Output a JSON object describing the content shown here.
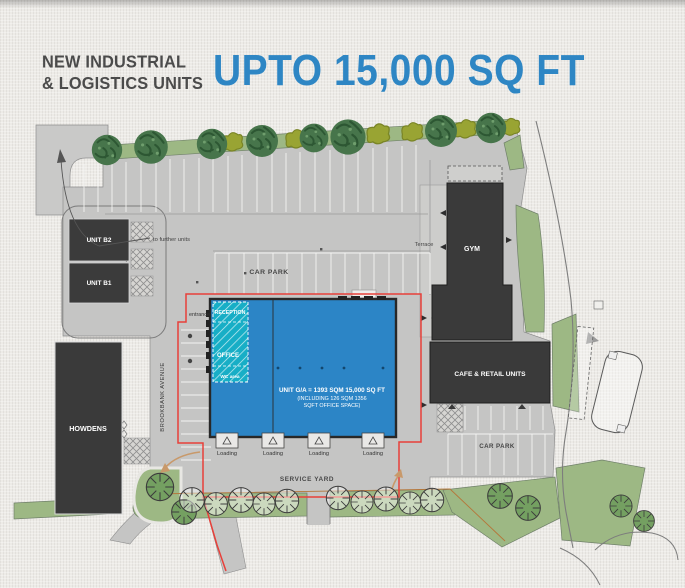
{
  "header": {
    "title_line1": "NEW INDUSTRIAL",
    "title_line2": "& LOGISTICS UNITS",
    "headline": "UPTO 15,000 SQ FT"
  },
  "plan": {
    "labels": {
      "to_further_units": "to further units",
      "unit_b2": "UNIT B2",
      "unit_b1": "UNIT B1",
      "car_park_top": "CAR PARK",
      "car_park_bottom": "CAR PARK",
      "terrace": "Terrace",
      "gym": "GYM",
      "cafe_retail": "CAFE & RETAIL UNITS",
      "howdens": "HOWDENS",
      "brookbank_avenue": "BROOKBANK AVENUE",
      "entrance": "entrance",
      "reception": "RECEPTION",
      "office": "OFFICE",
      "wc_area": "WC area",
      "service_yard": "SERVICE YARD"
    },
    "unit": {
      "gia_line1": "UNIT G/A = 1393 SQM 15,000 SQ FT",
      "gia_line2": "(INCLUDING 126 SQM 1356",
      "gia_line3": "SQFT OFFICE SPACE)"
    },
    "loading_bays": [
      "Loading",
      "Loading",
      "Loading",
      "Loading"
    ],
    "colors": {
      "headline_blue": "#2e86c4",
      "unit_blue": "#2c85c6",
      "office_teal": "#17aec6",
      "dark_building": "#3a3a3a",
      "boundary_red": "#e8403a",
      "tarmac_gray": "#c5c5c4",
      "landscape_green": "#9db884"
    }
  }
}
